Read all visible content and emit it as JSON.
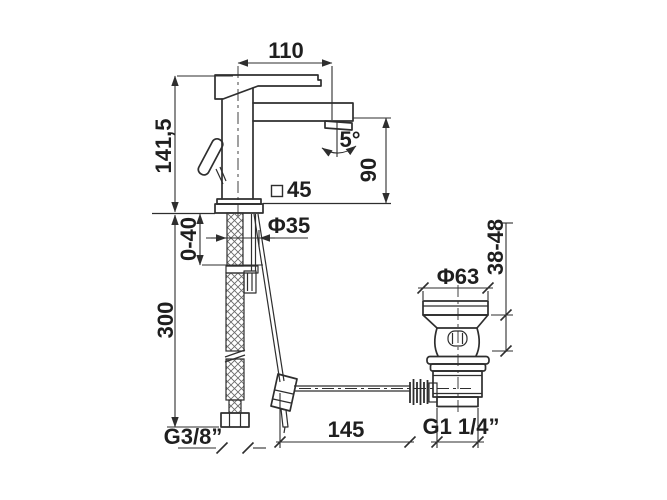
{
  "drawing": {
    "type": "technical-dimension-drawing",
    "subject": "Single-lever basin mixer faucet with flexible supply hoses and pop-up waste",
    "background_color": "#ffffff",
    "line_color": "#2e2e2e"
  },
  "dimensions": {
    "spout_reach": "110",
    "height_above_deck": "141,5",
    "outlet_height": "90",
    "aerator_angle": "5°",
    "body_section_value": "45",
    "shank_diameter": "Φ35",
    "deck_thickness_range": "0-40",
    "hose_length": "300",
    "flange_height_range": "38-48",
    "flange_diameter": "Φ63",
    "supply_thread": "G3/8”",
    "rod_length": "145",
    "waste_thread": "G1 1/4”"
  }
}
